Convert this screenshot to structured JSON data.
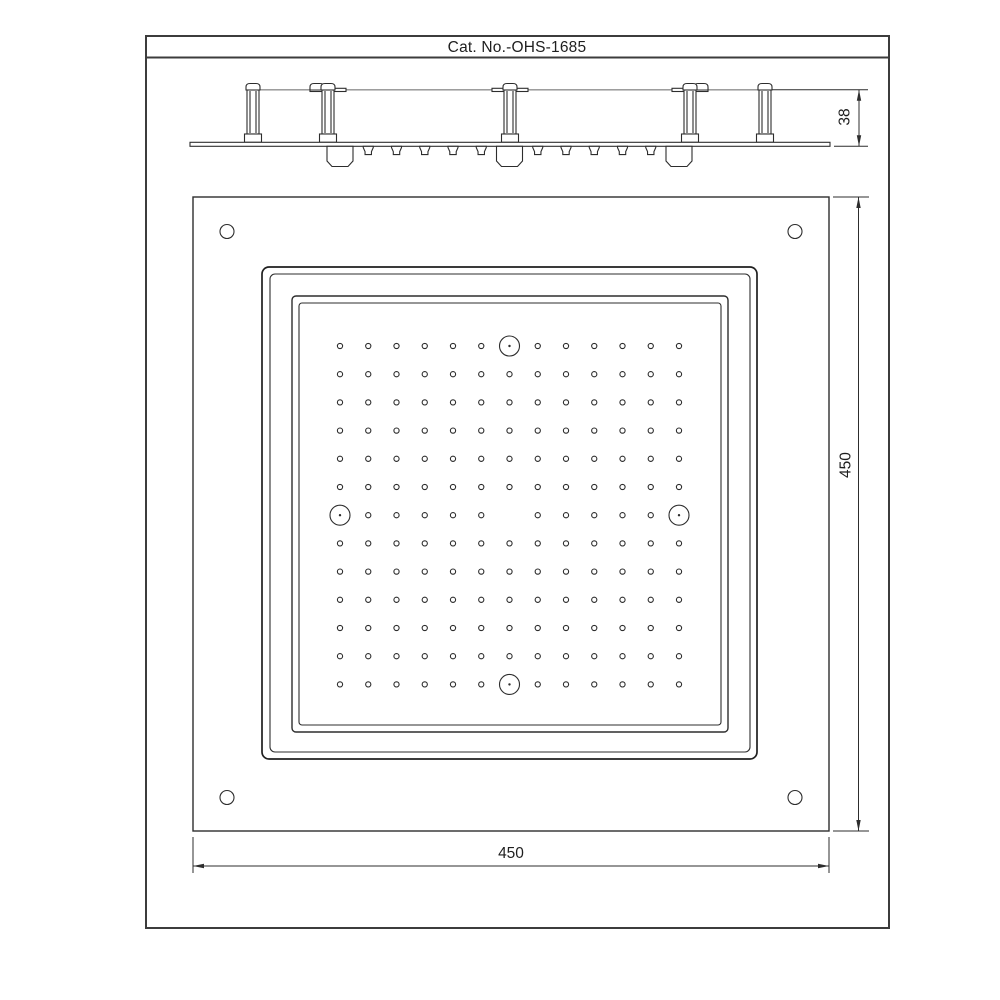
{
  "sheet": {
    "title": "Cat. No.-OHS-1685"
  },
  "side_view": {
    "mount_height_dim": "38",
    "posts": 5,
    "water_cups": 3,
    "small_nozzles": 10
  },
  "plan_view": {
    "width_dim": "450",
    "height_dim": "450",
    "corner_screw_holes": 4,
    "function_nozzles": 4,
    "spray_grid": {
      "rows": 13,
      "cols": 13
    }
  }
}
